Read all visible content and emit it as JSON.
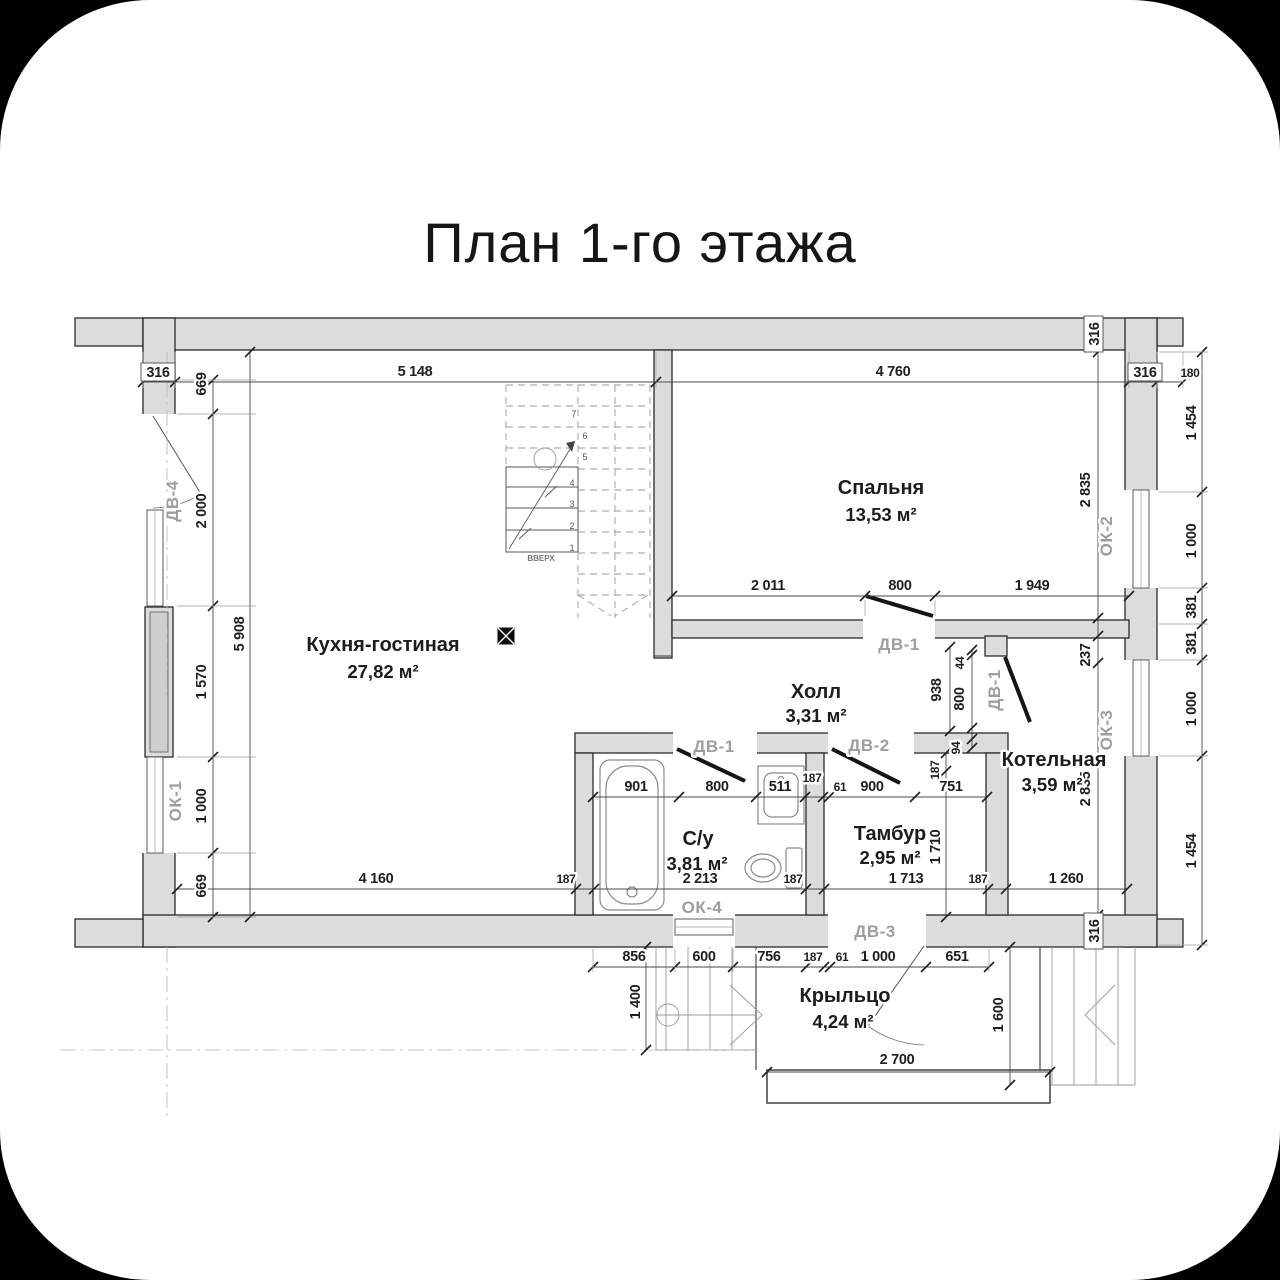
{
  "title": "План 1-го этажа",
  "rooms": {
    "kitchen": {
      "name": "Кухня-гостиная",
      "area": "27,82 м²"
    },
    "bedroom": {
      "name": "Спальня",
      "area": "13,53 м²"
    },
    "hall": {
      "name": "Холл",
      "area": "3,31 м²"
    },
    "bathroom": {
      "name": "С/у",
      "area": "3,81 м²"
    },
    "vestibule": {
      "name": "Тамбур",
      "area": "2,95 м²"
    },
    "boiler": {
      "name": "Котельная",
      "area": "3,59 м²"
    },
    "porch": {
      "name": "Крыльцо",
      "area": "4,24 м²"
    }
  },
  "windows": {
    "ok1": "ОК-1",
    "ok2": "ОК-2",
    "ok3": "ОК-3",
    "ok4": "ОК-4"
  },
  "doors": {
    "dv1": "ДВ-1",
    "dv2": "ДВ-2",
    "dv3": "ДВ-3",
    "dv4": "ДВ-4"
  },
  "stairs": {
    "up_label": "ВВЕРХ",
    "steps": [
      "1",
      "2",
      "3",
      "4",
      "5",
      "6",
      "7"
    ]
  },
  "dims": {
    "top": [
      "316",
      "5 148",
      "4 760",
      "316",
      "180"
    ],
    "left": [
      "669",
      "2 000",
      "1 570",
      "1 000",
      "669"
    ],
    "left_total": "5 908",
    "right": [
      "1 454",
      "1 000",
      "381",
      "381",
      "1 000",
      "1 454"
    ],
    "right_wall_top": "316",
    "right_wall_bottom": "316",
    "bedroom_bottom": [
      "2 011",
      "800",
      "1 949"
    ],
    "bedroom_height": "2 835",
    "boiler_offset": "237",
    "boiler_height": "2 835",
    "lobby": [
      "938",
      "44",
      "800",
      "94",
      "187",
      "1 710"
    ],
    "bath_top": [
      "901",
      "800",
      "511",
      "187",
      "61",
      "900",
      "751"
    ],
    "bottom": [
      "4 160",
      "187",
      "2 213",
      "187",
      "1 713",
      "187",
      "1 260"
    ],
    "porch_top": [
      "856",
      "600",
      "756",
      "187",
      "61",
      "1 000",
      "651"
    ],
    "porch_left": "1 400",
    "porch_right": "1 600",
    "porch_width": "2 700"
  },
  "colors": {
    "background": "#000000",
    "paper": "#ffffff",
    "wall_fill": "#dcdcdc",
    "line": "#1c1c1c",
    "muted_label": "#9e9e9e"
  }
}
